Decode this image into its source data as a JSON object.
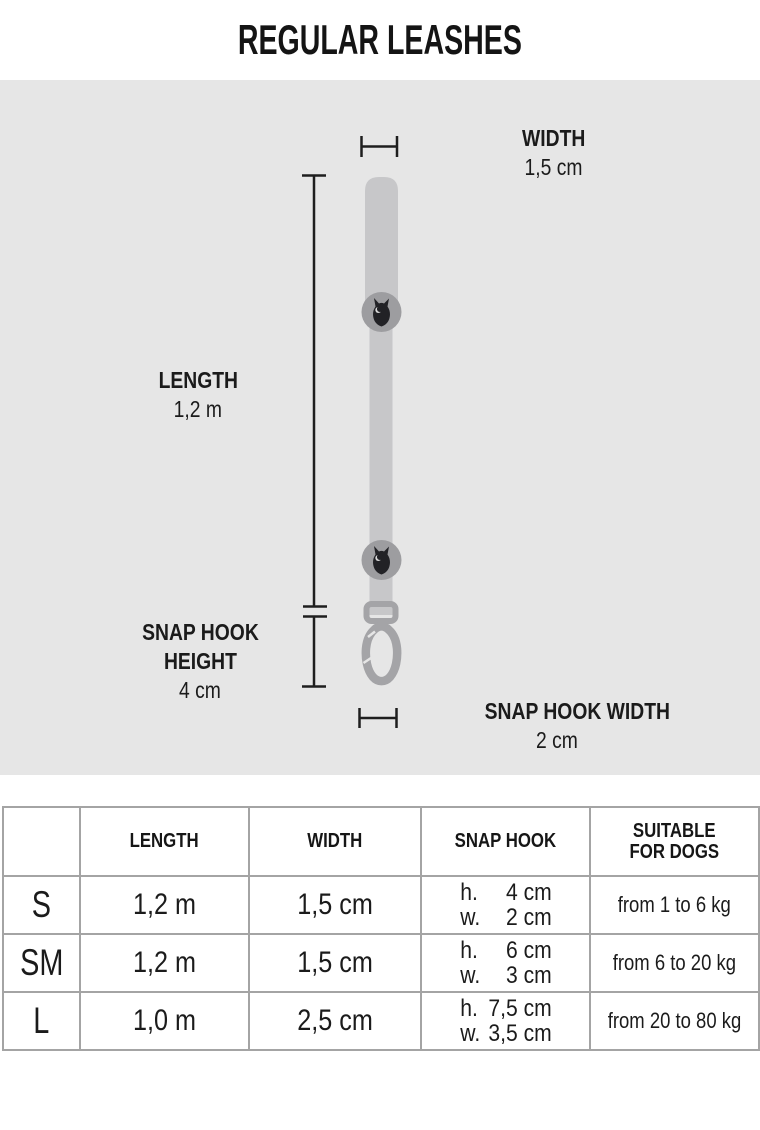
{
  "title": "REGULAR LEASHES",
  "diagram": {
    "width": {
      "label": "WIDTH",
      "value": "1,5 cm"
    },
    "length": {
      "label": "LENGTH",
      "value": "1,2 m"
    },
    "snap_hook_height": {
      "label_line1": "SNAP HOOK",
      "label_line2": "HEIGHT",
      "value": "4 cm"
    },
    "snap_hook_width": {
      "label": "SNAP HOOK WIDTH",
      "value": "2 cm"
    }
  },
  "table": {
    "headers": {
      "size": "",
      "length": "LENGTH",
      "width": "WIDTH",
      "snap_hook": "SNAP HOOK",
      "suitable_line1": "SUITABLE",
      "suitable_line2": "FOR DOGS"
    },
    "rows": [
      {
        "size": "S",
        "length": "1,2 m",
        "width": "1,5 cm",
        "hook_h_label": "h.",
        "hook_h": "4 cm",
        "hook_w_label": "w.",
        "hook_w": "2 cm",
        "dogs": "from 1 to 6 kg"
      },
      {
        "size": "SM",
        "length": "1,2 m",
        "width": "1,5 cm",
        "hook_h_label": "h.",
        "hook_h": "6 cm",
        "hook_w_label": "w.",
        "hook_w": "3 cm",
        "dogs": "from 6 to 20 kg"
      },
      {
        "size": "L",
        "length": "1,0 m",
        "width": "2,5 cm",
        "hook_h_label": "h.",
        "hook_h": "7,5 cm",
        "hook_w_label": "w.",
        "hook_w": "3,5 cm",
        "dogs": "from 20 to 80 kg"
      }
    ]
  },
  "colors": {
    "diagram_background": "#e6e6e6",
    "strap": "#c7c7c9",
    "medallion": "#9d9da0",
    "owl": "#222226",
    "hook_metal": "#a4a4a7",
    "dimension_lines": "#1e1e1e",
    "table_border": "#a4a4a4",
    "text": "#1b1b1b"
  }
}
